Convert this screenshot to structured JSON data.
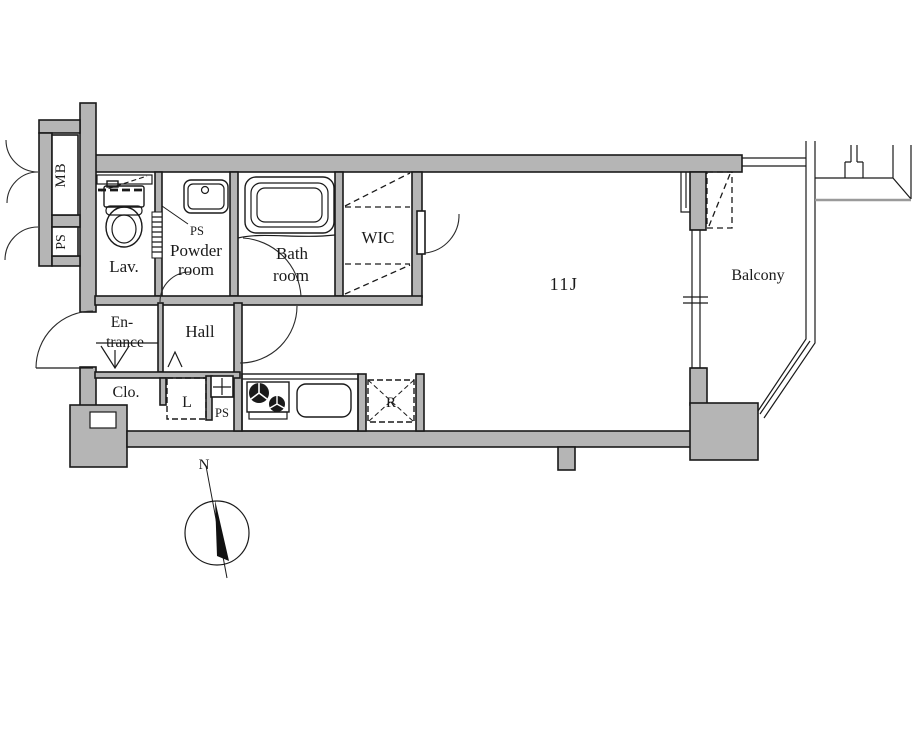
{
  "plan": {
    "labels": {
      "mb": "MB",
      "ps_meter": "PS",
      "lav": "Lav.",
      "powder_1": "Powder",
      "powder_2": "room",
      "ps_powder": "PS",
      "bath_1": "Bath",
      "bath_2": "room",
      "wic": "WIC",
      "main_room": "11J",
      "balcony": "Balcony",
      "entrance_1": "En-",
      "entrance_2": "trance",
      "hall": "Hall",
      "closet": "Clo.",
      "laundry": "L",
      "ps_kitchen": "PS",
      "refrigerator": "R"
    },
    "compass": {
      "north": "N"
    },
    "colors": {
      "wall": "#b5b5b5",
      "line": "#1a1a1a",
      "background": "#ffffff"
    }
  }
}
